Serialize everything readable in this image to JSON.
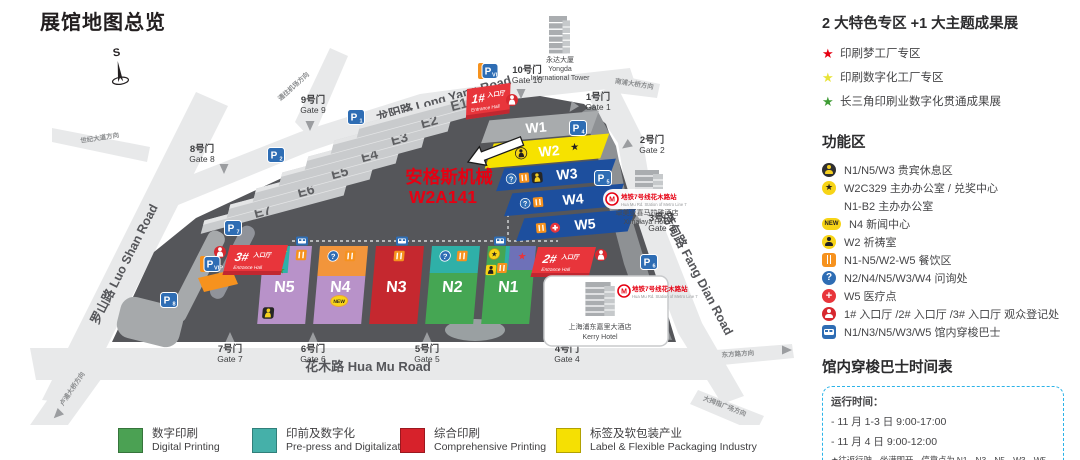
{
  "title": "展馆地图总览",
  "compass": "S",
  "icons": {
    "star": "★",
    "question": "?",
    "cross": "+",
    "new": "NEW"
  },
  "map": {
    "roads": {
      "long_yang": "龙阳路 Long Yang Road",
      "hua_mu": "花木路 Hua Mu Road",
      "luo_shan": "罗山路 Luo Shan Road",
      "fang_dian": "芳甸路 Fang Dian Road",
      "to_airport": "通往机场方向",
      "to_century": "世纪大道方向",
      "to_nanpu": "南浦大桥方向",
      "to_lupu": "卢浦大桥方向",
      "to_dongfang": "东方路方向",
      "to_thumb": "大拇指广场方向"
    },
    "halls_e": [
      "E1",
      "E2",
      "E3",
      "E4",
      "E5",
      "E6",
      "E7"
    ],
    "halls_w": [
      "W1",
      "W2",
      "W3",
      "W4",
      "W5"
    ],
    "halls_n": [
      "N5",
      "N4",
      "N3",
      "N2",
      "N1"
    ],
    "entrances": [
      {
        "num": "1#",
        "zh": "入口厅",
        "en": "Entrance Hall"
      },
      {
        "num": "2#",
        "zh": "入口厅",
        "en": "Entrance Hall"
      },
      {
        "num": "3#",
        "zh": "入口厅",
        "en": "Entrance Hall"
      }
    ],
    "gates": [
      {
        "zh": "1号门",
        "en": "Gate 1"
      },
      {
        "zh": "2号门",
        "en": "Gate 2"
      },
      {
        "zh": "3号门",
        "en": "Gate 3"
      },
      {
        "zh": "4号门",
        "en": "Gate 4"
      },
      {
        "zh": "5号门",
        "en": "Gate 5"
      },
      {
        "zh": "6号门",
        "en": "Gate 6"
      },
      {
        "zh": "7号门",
        "en": "Gate 7"
      },
      {
        "zh": "8号门",
        "en": "Gate 8"
      },
      {
        "zh": "9号门",
        "en": "Gate 9"
      },
      {
        "zh": "10号门",
        "en": "Gate 10"
      }
    ],
    "parking": [
      {
        "label": "P",
        "sub": "1"
      },
      {
        "label": "P",
        "sub": "2"
      },
      {
        "label": "P",
        "sub": "7"
      },
      {
        "label": "P",
        "sub": "8"
      },
      {
        "label": "P",
        "sub": "4"
      },
      {
        "label": "P",
        "sub": "5"
      },
      {
        "label": "P",
        "sub": "6"
      },
      {
        "label": "P",
        "sub": "VIP"
      },
      {
        "label": "P",
        "sub": "VIP"
      }
    ],
    "buildings": {
      "yongda_zh": "永达大厦",
      "yongda_en1": "Yongda",
      "yongda_en2": "International Tower",
      "ximalaya_zh": "卓美亚喜马拉雅酒店",
      "ximalaya_en": "Ximalaya Hotel",
      "kerry_zh": "上海浦东嘉里大酒店",
      "kerry_en": "Kerry Hotel"
    },
    "metro": {
      "label": "地铁7号线花木路站",
      "label_en": "Hua Mu Rd. Station of Metro Line 7"
    },
    "annotation": {
      "line1": "安格斯机械",
      "line2": "W2A141"
    }
  },
  "panel": {
    "special_title": "2 大特色专区 +1 大主题成果展",
    "special_items": [
      {
        "color": "#e60012",
        "text": "印刷梦工厂专区"
      },
      {
        "color": "#e8e337",
        "text": "印刷数字化工厂专区"
      },
      {
        "color": "#3f9c35",
        "text": "长三角印刷业数字化贯通成果展"
      }
    ],
    "function_title": "功能区",
    "function_items": [
      {
        "icon": "vip-lounge",
        "text": "N1/N5/W3 贵宾休息区"
      },
      {
        "icon": "star-circle",
        "text": "W2C329 主办办公室 / 兑奖中心"
      },
      {
        "icon": "none",
        "text": "N1-B2 主办办公室"
      },
      {
        "icon": "new-badge",
        "text": "N4 新闻中心"
      },
      {
        "icon": "prayer",
        "text": "W2 祈祷室"
      },
      {
        "icon": "restaurant",
        "text": "N1-N5/W2-W5 餐饮区"
      },
      {
        "icon": "question",
        "text": "N2/N4/N5/W3/W4 问询处"
      },
      {
        "icon": "medical",
        "text": "W5 医疗点"
      },
      {
        "icon": "registration",
        "text": "1# 入口厅 /2# 入口厅 /3# 入口厅 观众登记处"
      },
      {
        "icon": "bus",
        "text": "N1/N3/N5/W3/W5 馆内穿梭巴士"
      }
    ],
    "shuttle_title": "馆内穿梭巴士时间表",
    "shuttle_box": [
      "运行时间：",
      "- 11 月 1-3 日 9:00-17:00",
      "- 11 月 4 日 9:00-12:00",
      "★往返行驶，坐满即开，停靠点为 N1、N3、N5、W3、W5"
    ]
  },
  "legend": [
    {
      "color": "#4ba153",
      "zh": "数字印刷",
      "en": "Digital Printing"
    },
    {
      "color": "#45b0a9",
      "zh": "印前及数字化",
      "en": "Pre-press and Digitalization"
    },
    {
      "color": "#d7222b",
      "zh": "综合印刷",
      "en": "Comprehensive Printing"
    },
    {
      "color": "#f5e003",
      "zh": "标签及软包装产业",
      "en": "Label & Flexible Packaging Industry"
    }
  ]
}
